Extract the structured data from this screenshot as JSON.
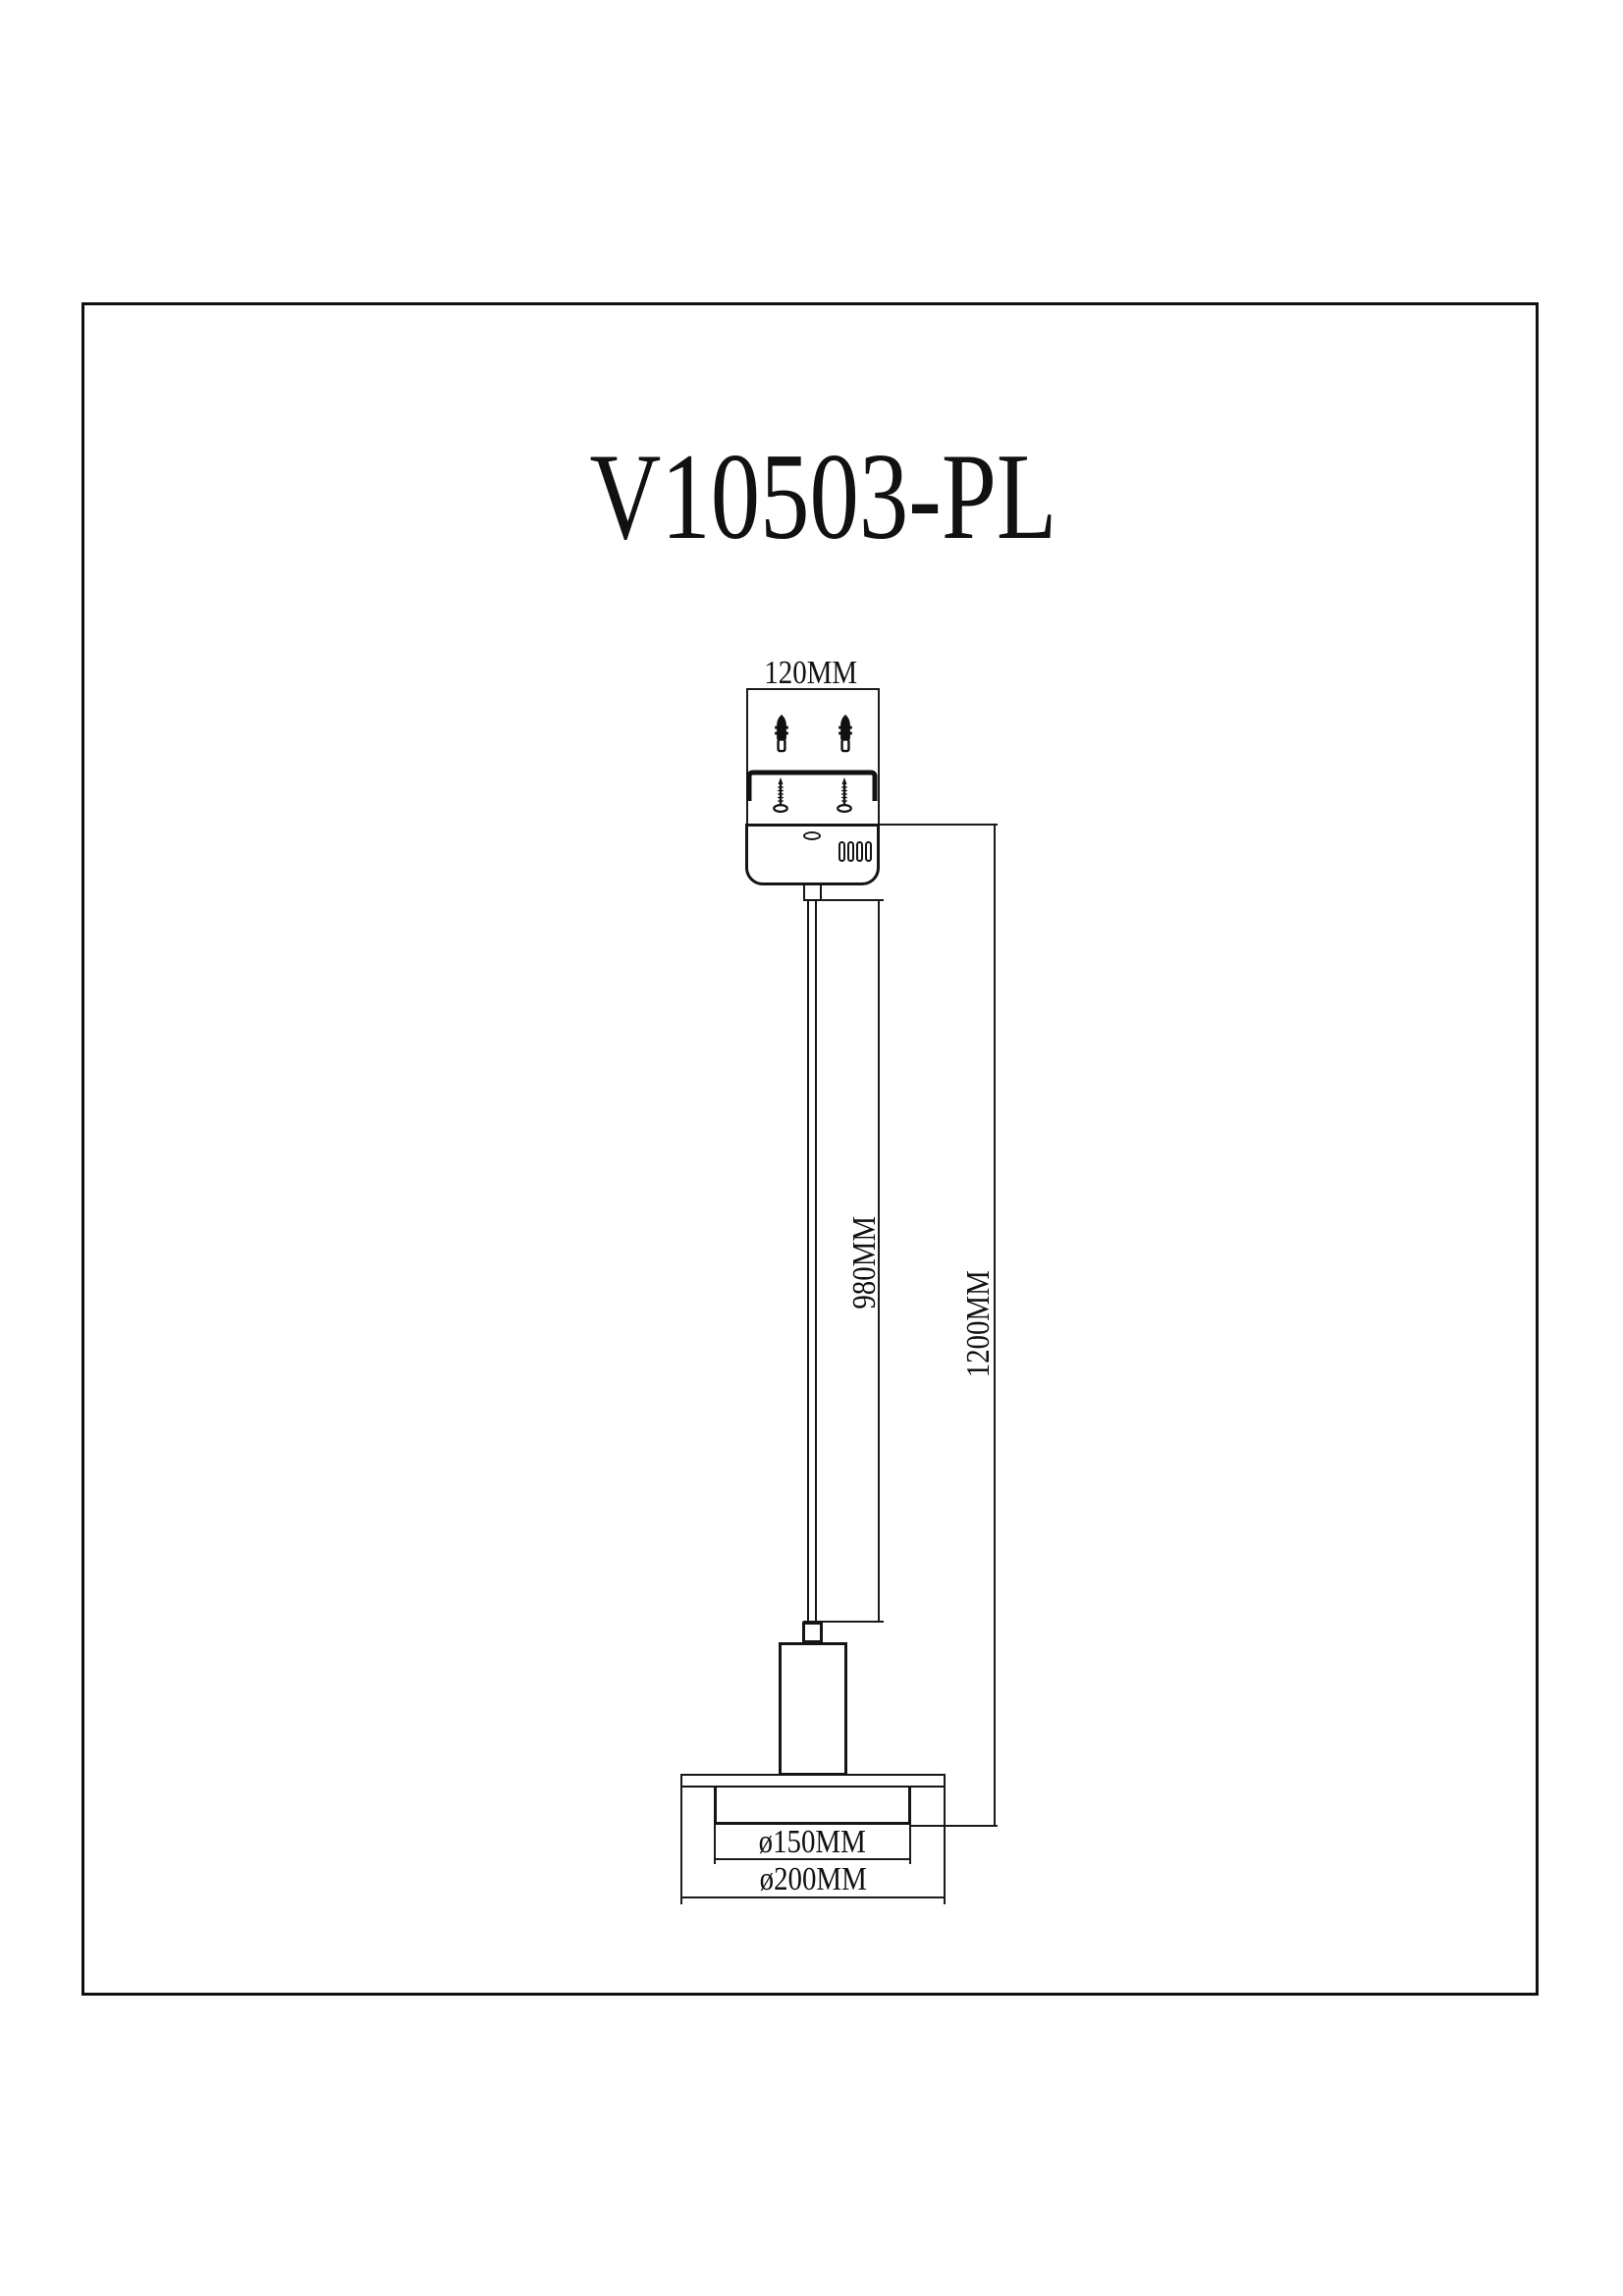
{
  "page": {
    "background": "#ffffff",
    "line_color": "#151515"
  },
  "title": "V10503-PL",
  "drawing": {
    "labels": {
      "canopy_width": "120MM",
      "cord_length": "980MM",
      "overall_drop": "1200MM",
      "shade_inner_diameter": "ø150MM",
      "shade_outer_diameter": "ø200MM"
    }
  }
}
